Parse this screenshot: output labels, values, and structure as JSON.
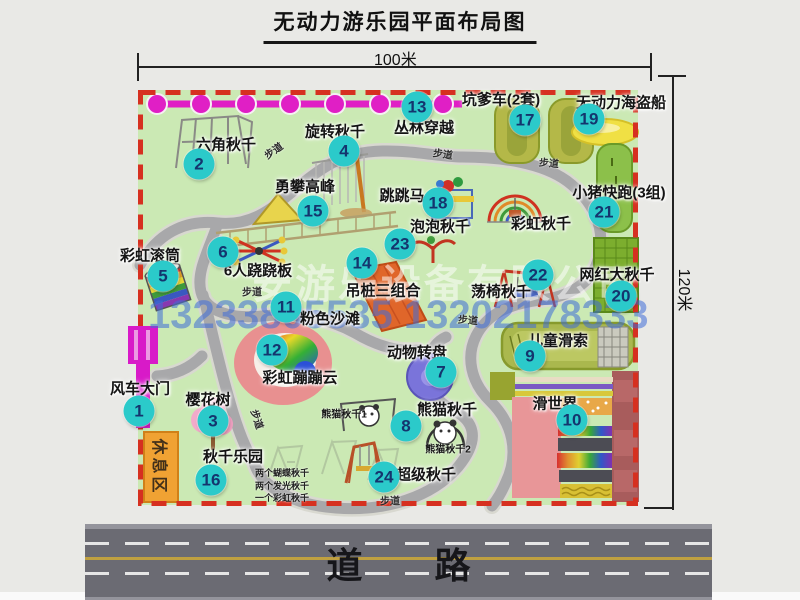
{
  "title": "无动力游乐园平面布局图",
  "dim_width": "100米",
  "dim_height": "120米",
  "road": {
    "label": "道　　路"
  },
  "watermark": {
    "company": "安游乐设备有限公司",
    "phone": "13233805535 13202178333"
  },
  "rest_area": {
    "label": "休息区"
  },
  "walkway_label": "步道",
  "walkways": [
    {
      "x": 273,
      "y": 150,
      "r": -35
    },
    {
      "x": 443,
      "y": 153,
      "r": 8
    },
    {
      "x": 549,
      "y": 162,
      "r": 5
    },
    {
      "x": 252,
      "y": 291,
      "r": 0
    },
    {
      "x": 468,
      "y": 319,
      "r": 5
    },
    {
      "x": 390,
      "y": 500,
      "r": 0
    },
    {
      "x": 258,
      "y": 419,
      "r": 72
    }
  ],
  "attractions": [
    {
      "num": "1",
      "name": "风车大门",
      "bx": 139,
      "by": 411,
      "lx": 140,
      "ly": 388
    },
    {
      "num": "2",
      "name": "六角秋千",
      "bx": 199,
      "by": 164,
      "lx": 226,
      "ly": 144
    },
    {
      "num": "3",
      "name": "樱花树",
      "bx": 213,
      "by": 421,
      "lx": 208,
      "ly": 399
    },
    {
      "num": "4",
      "name": "旋转秋千",
      "bx": 344,
      "by": 151,
      "lx": 335,
      "ly": 131
    },
    {
      "num": "5",
      "name": "彩虹滚筒",
      "bx": 163,
      "by": 276,
      "lx": 150,
      "ly": 255
    },
    {
      "num": "6",
      "name": "6人跷跷板",
      "bx": 223,
      "by": 252,
      "lx": 258,
      "ly": 270
    },
    {
      "num": "7",
      "name": "动物转盘",
      "bx": 441,
      "by": 372,
      "lx": 417,
      "ly": 352
    },
    {
      "num": "8",
      "name": "熊猫秋千",
      "bx": 406,
      "by": 426,
      "lx": 447,
      "ly": 409
    },
    {
      "num": "9",
      "name": "儿童滑索",
      "bx": 530,
      "by": 356,
      "lx": 558,
      "ly": 340
    },
    {
      "num": "10",
      "name": "滑世界",
      "bx": 572,
      "by": 420,
      "lx": 555,
      "ly": 403
    },
    {
      "num": "11",
      "name": "粉色沙滩",
      "bx": 286,
      "by": 307,
      "lx": 330,
      "ly": 318
    },
    {
      "num": "12",
      "name": "彩虹蹦蹦云",
      "bx": 272,
      "by": 350,
      "lx": 300,
      "ly": 377
    },
    {
      "num": "13",
      "name": "丛林穿越",
      "bx": 417,
      "by": 107,
      "lx": 424,
      "ly": 127
    },
    {
      "num": "14",
      "name": "吊桩三组合",
      "bx": 362,
      "by": 263,
      "lx": 383,
      "ly": 290
    },
    {
      "num": "15",
      "name": "勇攀高峰",
      "bx": 313,
      "by": 211,
      "lx": 305,
      "ly": 186
    },
    {
      "num": "16",
      "name": "秋千乐园",
      "bx": 211,
      "by": 480,
      "lx": 233,
      "ly": 456
    },
    {
      "num": "17",
      "name": "坑爹车(2套)",
      "bx": 525,
      "by": 120,
      "lx": 501,
      "ly": 99
    },
    {
      "num": "18",
      "name": "跳跳马",
      "bx": 438,
      "by": 203,
      "lx": 402,
      "ly": 195
    },
    {
      "num": "19",
      "name": "无动力海盗船",
      "bx": 589,
      "by": 119,
      "lx": 621,
      "ly": 102
    },
    {
      "num": "20",
      "name": "网红大秋千",
      "bx": 621,
      "by": 296,
      "lx": 617,
      "ly": 274
    },
    {
      "num": "21",
      "name": "小猪快跑(3组)",
      "bx": 604,
      "by": 212,
      "lx": 619,
      "ly": 192
    },
    {
      "num": "22",
      "name": "荡椅秋千",
      "bx": 538,
      "by": 275,
      "lx": 501,
      "ly": 291
    },
    {
      "num": "23",
      "name": "泡泡秋千",
      "bx": 400,
      "by": 244,
      "lx": 440,
      "ly": 226
    },
    {
      "num": "24",
      "name": "超级秋千",
      "bx": 384,
      "by": 477,
      "lx": 426,
      "ly": 474
    },
    {
      "num": "",
      "name": "彩虹秋千",
      "lx": 541,
      "ly": 223
    }
  ],
  "sub_labels": [
    {
      "text": "熊猫秋千1",
      "x": 344,
      "y": 413
    },
    {
      "text": "熊猫秋千2",
      "x": 448,
      "y": 448
    }
  ],
  "swing_notes": {
    "x": 255,
    "y": 467,
    "lines": [
      "两个蝴蝶秋千",
      "两个发光秋千",
      "一个彩虹秋千"
    ]
  },
  "colors": {
    "park_green": "#cbe9b4",
    "dashed_border": "#d63020",
    "badge": "#2bcaca",
    "jungle_line": "#e01fc5",
    "gate_magenta": "#d81ac8",
    "road_gray": "#6b6b73"
  }
}
